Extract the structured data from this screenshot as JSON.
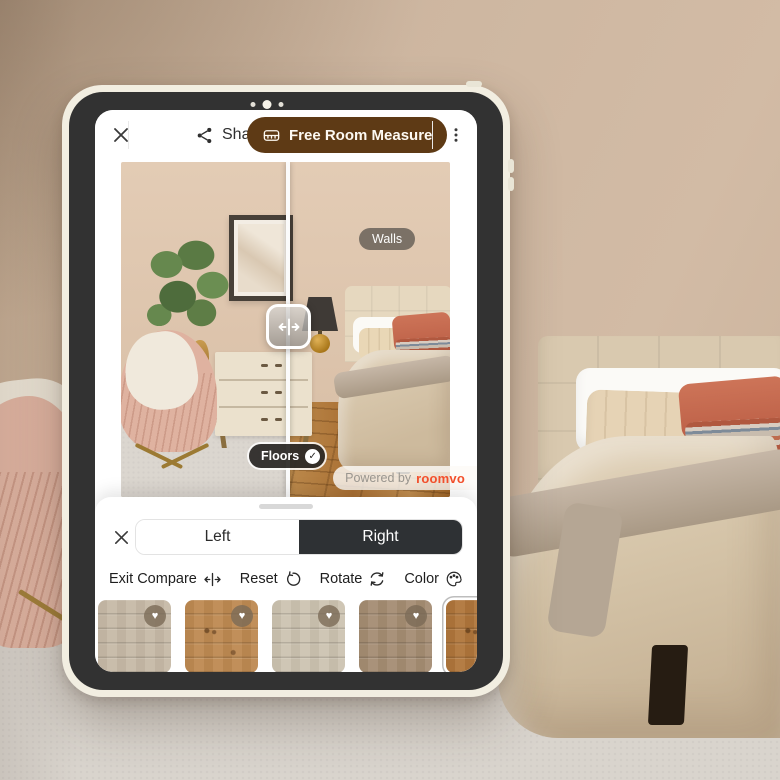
{
  "app": {
    "top_bar": {
      "share": {
        "label": "Share"
      },
      "measure_button": {
        "label": "Free Room Measure"
      }
    },
    "viewer": {
      "tags": {
        "walls": "Walls",
        "floors": "Floors"
      },
      "watermark": {
        "prefix": "Powered by",
        "brand": "roomvo"
      }
    },
    "sheet": {
      "segments": [
        {
          "label": "Left",
          "selected": false
        },
        {
          "label": "Right",
          "selected": true
        }
      ],
      "tools": [
        {
          "label": "Exit Compare",
          "icon": "compare-arrows-icon"
        },
        {
          "label": "Reset",
          "icon": "undo-icon"
        },
        {
          "label": "Rotate",
          "icon": "rotate-icon"
        },
        {
          "label": "Color",
          "icon": "palette-icon"
        }
      ],
      "swatches": [
        {
          "name": "light greige oak",
          "color": "#C7BAA7",
          "favorited": true,
          "selected": false
        },
        {
          "name": "warm honey oak",
          "color": "#BE8A52",
          "favorited": true,
          "selected": false
        },
        {
          "name": "pale ash oak",
          "color": "#CDC3B1",
          "favorited": true,
          "selected": false
        },
        {
          "name": "taupe oak",
          "color": "#A58D73",
          "favorited": true,
          "selected": false
        },
        {
          "name": "rustic golden oak",
          "color": "#B0763C",
          "favorited": false,
          "selected": true
        }
      ]
    }
  },
  "icons": {
    "heart": "♥",
    "check": "✓"
  },
  "colors": {
    "accent_brown": "#5E3A15",
    "segment_dark": "#2E3134",
    "brand_red": "#F4502C",
    "frame_cream": "#F2EEE1",
    "bezel_dark": "#323232"
  }
}
